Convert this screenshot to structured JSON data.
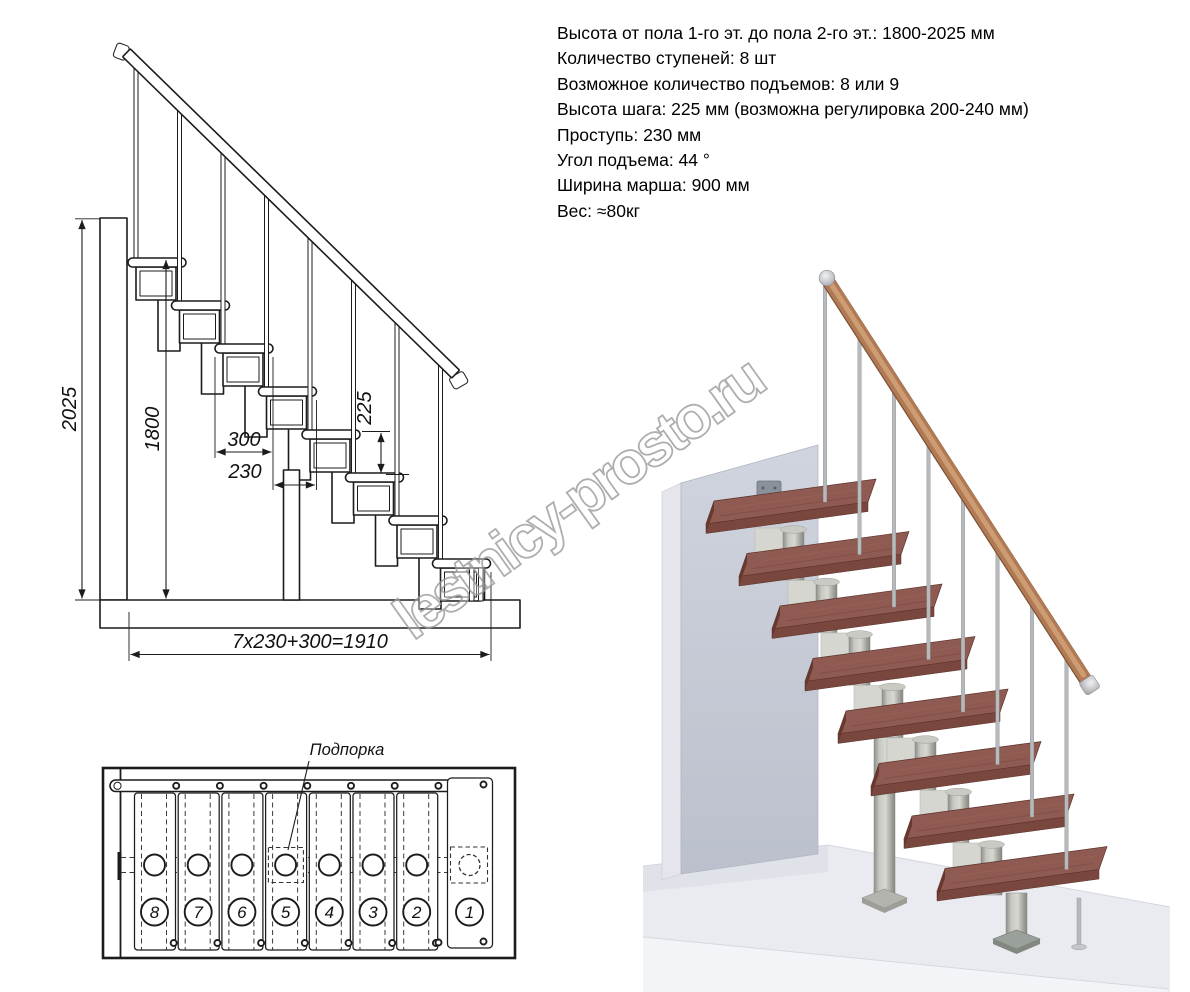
{
  "specs": {
    "lines": [
      "Высота от пола 1-го эт. до пола 2-го эт.: 1800-2025 мм",
      "Количество ступеней: 8 шт",
      "Возможное количество подъемов: 8 или 9",
      "Высота шага: 225 мм (возможна регулировка 200-240 мм)",
      "Проступь: 230 мм",
      "Угол подъема: 44 °",
      "Ширина марша: 900 мм",
      "Вес: ≈80кг"
    ]
  },
  "side_view": {
    "dim_height_total": "2025",
    "dim_height_floor": "1800",
    "dim_tread_depth": "300",
    "dim_step_run": "230",
    "dim_step_rise": "225",
    "dim_total_run": "7x230+300=1910"
  },
  "top_view": {
    "support_label": "Подпорка",
    "step_numbers": [
      "8",
      "7",
      "6",
      "5",
      "4",
      "3",
      "2",
      "1"
    ]
  },
  "watermark": {
    "text": "lestnicy-prosto.ru",
    "color": "#9b9b9b"
  },
  "colors": {
    "line": "#1c1c1c",
    "wood_tread": "#8e5a51",
    "wood_rail": "#b07a54",
    "metal": "#b5b5b0",
    "wall": "#c9cdd7",
    "floor": "#e9ebf1"
  }
}
